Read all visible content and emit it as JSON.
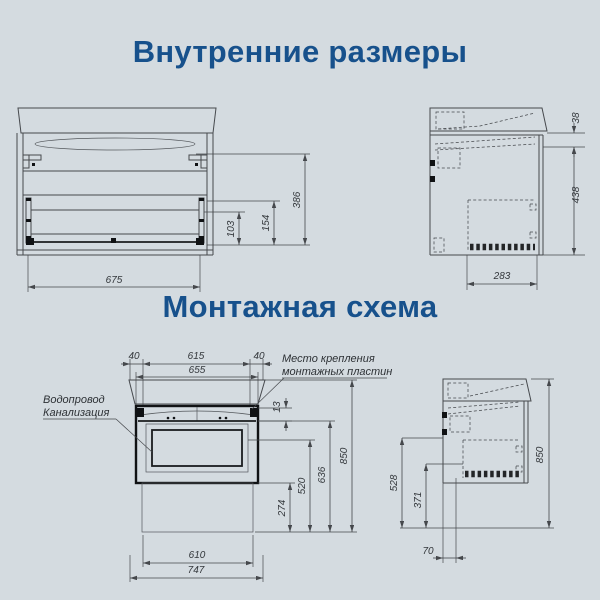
{
  "page": {
    "background_color": "#d4dbe0",
    "accent_color": "#17518c",
    "line_color": "#46494d"
  },
  "titles": {
    "internal_dimensions": "Внутренние размеры",
    "mounting_scheme": "Монтажная схема"
  },
  "internal_front_view": {
    "bottom_width": "675",
    "inner_height": "386",
    "drawer_zone_height": "154",
    "lower_drawer_height": "103"
  },
  "internal_side_view": {
    "countertop_drop": "38",
    "inner_height": "438",
    "inner_depth": "283"
  },
  "mounting_front_view": {
    "plate_offset_left": "40",
    "plate_spacing": "615",
    "plate_offset_right": "40",
    "cabinet_width": "655",
    "plate_drop": "13",
    "height_total": "850",
    "height_rail": "636",
    "height_supply": "520",
    "height_bottom": "274",
    "hatch_width": "610",
    "overall_width": "747",
    "label_water_supply": "Водопровод",
    "label_sewerage": "Канализация",
    "label_plates_line1": "Место крепления",
    "label_plates_line2": "монтажных пластин"
  },
  "mounting_side_view": {
    "height_supply": "528",
    "height_drain": "371",
    "back_offset": "70",
    "height_total": "850"
  }
}
